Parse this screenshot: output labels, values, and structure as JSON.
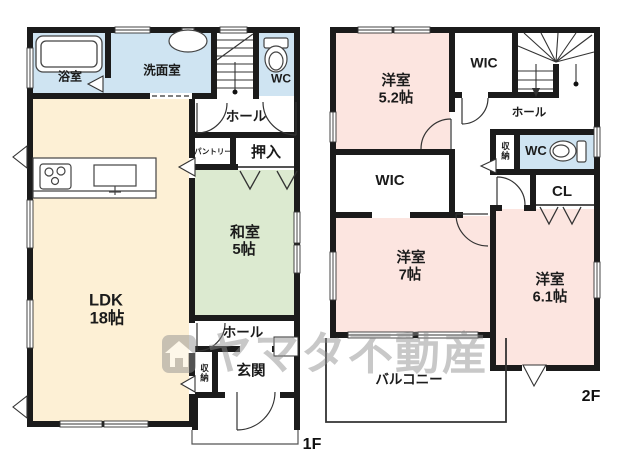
{
  "floor1": {
    "floor_label": "1F",
    "bath": "浴室",
    "washroom": "洗面室",
    "wc": "WC",
    "hall_upper": "ホール",
    "pantry": "パントリー",
    "oshiire": "押入",
    "washitsu_name": "和室",
    "washitsu_size": "5帖",
    "ldk_name": "LDK",
    "ldk_size": "18帖",
    "hall_lower": "ホール",
    "storage": "収納",
    "entrance": "玄関"
  },
  "floor2": {
    "floor_label": "2F",
    "bedroom52_name": "洋室",
    "bedroom52_size": "5.2帖",
    "wic_top": "WIC",
    "wic_mid": "WIC",
    "hall": "ホール",
    "storage": "収納",
    "wc": "WC",
    "cl": "CL",
    "bedroom7_name": "洋室",
    "bedroom7_size": "7帖",
    "bedroom61_name": "洋室",
    "bedroom61_size": "6.1帖",
    "balcony": "バルコニー"
  },
  "watermark": "ヤマタ不動産",
  "colors": {
    "wet_room": "#cfe4f2",
    "ldk": "#fdf0d5",
    "tatami": "#dcead0",
    "bedroom": "#fce5e0",
    "wall": "#1b1b1b"
  }
}
